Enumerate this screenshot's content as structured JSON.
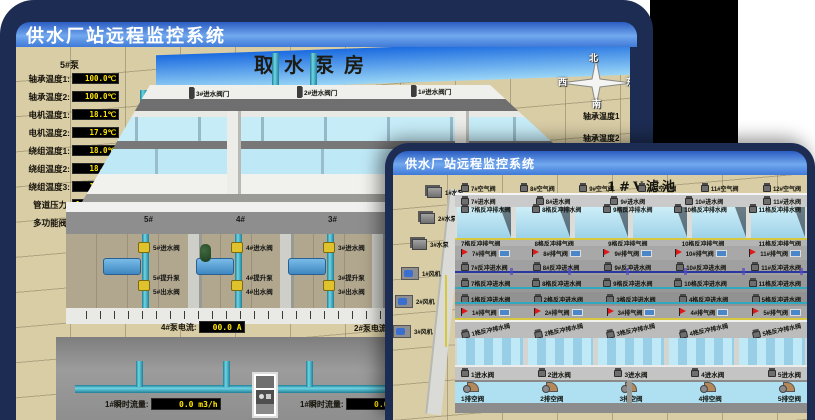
{
  "colors": {
    "title_gradient_start": "#2b5cc2",
    "title_gradient_mid": "#71a8ee",
    "title_gradient_end": "#3f7ad8",
    "lcd_text": "#ffe600",
    "alarm_red": "#e01818",
    "pipe_cyan": "#3fb6ce",
    "valve_yellow": "#e0c22c",
    "sky_blue": "#1b6be0",
    "ground_tan": "#d9cda6",
    "window_frame": "#1d2c52"
  },
  "back_window": {
    "title": "供水厂站远程监控系统",
    "scene_title": "取水泵房",
    "pump_panel": {
      "header": "5#泵",
      "rows": [
        {
          "label": "轴承温度1:",
          "value": "100.0℃"
        },
        {
          "label": "轴承温度2:",
          "value": "100.0℃"
        },
        {
          "label": "电机温度1:",
          "value": "18.1℃"
        },
        {
          "label": "电机温度2:",
          "value": "17.9℃"
        },
        {
          "label": "绕组温度1:",
          "value": "18.0℃"
        },
        {
          "label": "绕组温度2:",
          "value": "18.1℃"
        },
        {
          "label": "绕组温度3:",
          "value": "18.1℃"
        },
        {
          "label": "管道压力:",
          "value": "0.0007MPa"
        },
        {
          "label": "多功能阀:",
          "value": "0%"
        }
      ]
    },
    "intake_valves": [
      "3#进水阀门",
      "2#进水阀门",
      "1#进水阀门"
    ],
    "compass": {
      "north": "北",
      "west": "西",
      "south": "南",
      "east": "东"
    },
    "right_panel_labels": [
      "轴承温度1",
      "轴承温度2"
    ],
    "pump_bay_numbers": [
      "5#",
      "4#",
      "3#"
    ],
    "pump_bays": [
      {
        "valve_in": "5#进水阀",
        "pump": "5#提升泵",
        "valve_out": "5#出水阀"
      },
      {
        "valve_in": "4#进水阀",
        "pump": "4#提升泵",
        "valve_out": "4#出水阀"
      },
      {
        "valve_in": "3#进水阀",
        "pump": "3#提升泵",
        "valve_out": "3#出水阀"
      }
    ],
    "current_readouts": [
      {
        "label": "4#泵电流:",
        "value": "00.0 A"
      },
      {
        "label": "2#泵电流:",
        "value": ""
      }
    ],
    "flow_readouts": [
      {
        "label": "1#瞬时流量:",
        "value": "0.0 m3/h"
      },
      {
        "label": "1#瞬时流量:",
        "value": "0.0 m3/h"
      }
    ]
  },
  "front_window": {
    "title": "供水厂站远程监控系统",
    "scene_title": "1#V滤池",
    "pumps": [
      "1#水泵",
      "2#水泵",
      "3#水泵"
    ],
    "fans": [
      "1#风机",
      "2#风机",
      "3#风机"
    ],
    "air_valves": [
      "7#空气阀",
      "8#空气阀",
      "9#空气阀",
      "10#空气阀",
      "11#空气阀",
      "12#空气阀"
    ],
    "inlet_valves_back": [
      "7#进水阀",
      "8#进水阀",
      "9#进水阀",
      "10#进水阀",
      "11#进水阀"
    ],
    "backwash_drain_labels": [
      "7格反冲排水阀",
      "8格反冲排水阀",
      "9格反冲排水阀",
      "10格反冲排水阀",
      "11格反冲排水阀"
    ],
    "backwash_air_labels": [
      "7格反冲排气阀",
      "8格反冲排气阀",
      "9格反冲排气阀",
      "10格反冲排气阀",
      "11格反冲排气阀"
    ],
    "vent_valves_upper": [
      "7#排气阀",
      "8#排气阀",
      "9#排气阀",
      "10#排气阀",
      "11#排气阀"
    ],
    "backwash_inlet_upper": [
      "7#反冲进水阀",
      "8#反冲进水阀",
      "9#反冲进水阀",
      "10#反冲进水阀",
      "11#反冲进水阀"
    ],
    "backwash_inlet_mid": [
      "7格反冲进水阀",
      "8格反冲进水阀",
      "9格反冲进水阀",
      "10格反冲进水阀",
      "11格反冲进水阀"
    ],
    "backwash_inlet_lower": [
      "1格反冲进水阀",
      "2格反冲进水阀",
      "3格反冲进水阀",
      "4格反冲进水阀",
      "5格反冲进水阀"
    ],
    "vent_valves_lower": [
      "1#排气阀",
      "2#排气阀",
      "3#排气阀",
      "4#排气阀",
      "5#排气阀"
    ],
    "front_drain_labels": [
      "1格反冲排水阀",
      "2格反冲排水阀",
      "3格反冲排水阀",
      "4格反冲排水阀",
      "5格反冲排水阀"
    ],
    "inlet_valves_front": [
      "1进水阀",
      "2进水阀",
      "3进水阀",
      "4进水阀",
      "5进水阀"
    ],
    "empty_valves": [
      "1排空阀",
      "2排空阀",
      "3排空阀",
      "4排空阀",
      "5排空阀"
    ]
  }
}
